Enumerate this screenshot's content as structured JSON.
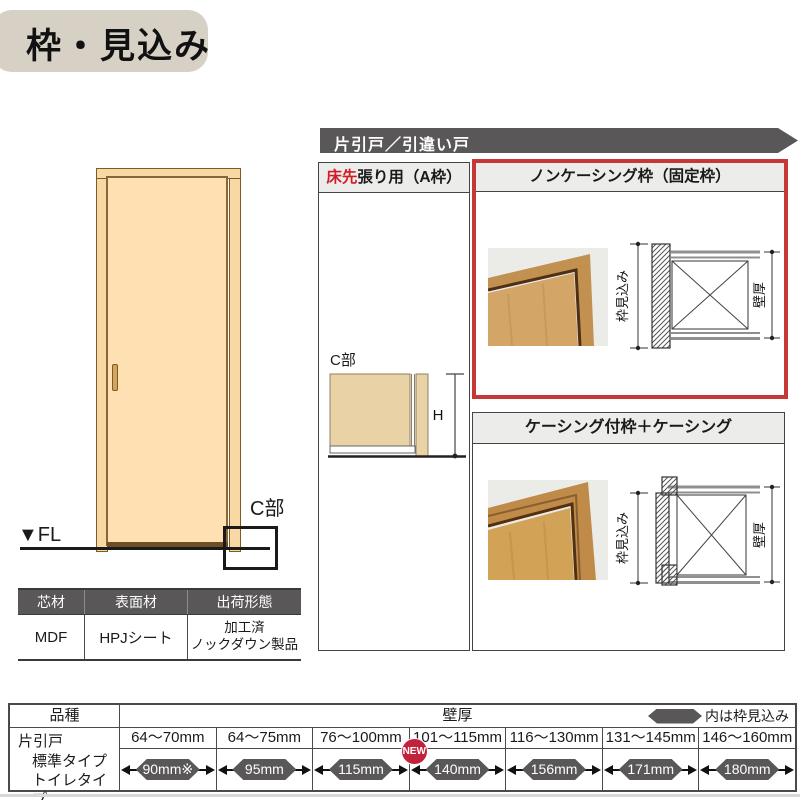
{
  "title_badge": "枠・見込み",
  "banner_label": "片引戸／引違い戸",
  "door_area": {
    "fl_label": "▼FL",
    "c_part_label": "C部"
  },
  "material_table": {
    "headers": [
      "芯材",
      "表面材",
      "出荷形態"
    ],
    "core": "MDF",
    "surface": "HPJシート",
    "shipping_line1": "加工済",
    "shipping_line2": "ノックダウン製品"
  },
  "section_a": {
    "title_red": "床先",
    "title_rest": "張り用（A枠）",
    "c_part_label": "C部",
    "height_label": "H"
  },
  "section_noncasing": {
    "title": "ノンケーシング枠（固定枠）",
    "frame_depth_label": "枠見込み",
    "wall_label": "壁厚"
  },
  "section_casing": {
    "title": "ケーシング付枠＋ケーシング",
    "frame_depth_label": "枠見込み",
    "wall_label": "壁厚"
  },
  "spec_table": {
    "type_header": "品種",
    "wall_header": "壁厚",
    "legend_note": "内は枠見込み",
    "row_labels": [
      "片引戸",
      "標準タイプ",
      "トイレタイプ"
    ],
    "columns": [
      {
        "range": "64〜70mm",
        "frame": "90mm※"
      },
      {
        "range": "64〜75mm",
        "frame": "95mm"
      },
      {
        "range": "76〜100mm",
        "frame": "115mm"
      },
      {
        "range": "101〜115mm",
        "frame": "140mm",
        "badge": "NEW"
      },
      {
        "range": "116〜130mm",
        "frame": "156mm"
      },
      {
        "range": "131〜145mm",
        "frame": "171mm"
      },
      {
        "range": "146〜160mm",
        "frame": "180mm"
      }
    ]
  },
  "colors": {
    "dark_gray": "#595757",
    "header_gray": "#ececeb",
    "accent_red": "#c53836",
    "badge_red": "#c3223d",
    "door_tan": "#ffe0b2",
    "title_beige": "#d6d0c5"
  }
}
